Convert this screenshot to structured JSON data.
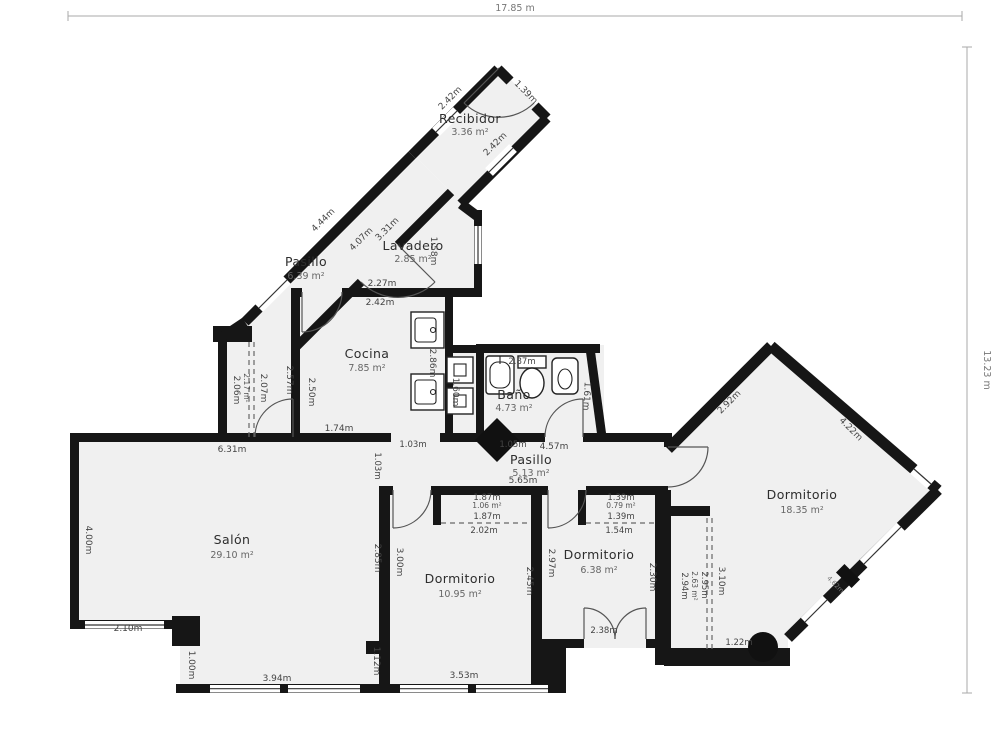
{
  "overall": {
    "width": "17.85 m",
    "height": "13.23 m"
  },
  "recibidor": {
    "name": "Recibidor",
    "area": "3.36 m²",
    "dim_nw": "2.42m",
    "dim_ne": "1.39m",
    "dim_se": "2.42m"
  },
  "pasillo_sup": {
    "name": "Pasillo",
    "area": "6.39 m²",
    "dim_outer": "4.44m",
    "dim_inner_a": "4.07m",
    "dim_inner_b": "3.31m"
  },
  "lavadero": {
    "name": "Lavadero",
    "area": "2.85 m²",
    "dim_right": "1.58m",
    "dim_bottom_inner": "2.27m",
    "dim_bottom_outer": "2.42m"
  },
  "cocina": {
    "name": "Cocina",
    "area": "7.85 m²",
    "dim_left_outer": "2.57m",
    "dim_left_inner": "2.50m",
    "dim_right": "2.86m",
    "dim_bottom": "1.74m",
    "dim_closet": "1.60m"
  },
  "vestibulo": {
    "dim_wall": "2.06m",
    "area_label": "2.17 m²",
    "dim_opening": "2.07m"
  },
  "bano": {
    "name": "Baño",
    "area": "4.73 m²",
    "dim_top": "2.87m",
    "dim_right": "1.61m",
    "dim_bottom": "1.05m"
  },
  "pasillo_inf": {
    "name": "Pasillo",
    "area": "5.13 m²",
    "dim_top": "4.57m",
    "dim_bottom": "5.65m",
    "dim_opening_h": "1.03m",
    "dim_opening_v": "1.03m"
  },
  "salon": {
    "name": "Salón",
    "area": "29.10 m²",
    "dim_top": "6.31m",
    "dim_left": "4.00m",
    "dim_bottom_left": "2.10m",
    "dim_step": "1.00m",
    "dim_bottom": "3.94m",
    "dim_right_step": "1.12m",
    "dim_right": "2.85m"
  },
  "dorm1": {
    "name": "Dormitorio",
    "area": "10.95 m²",
    "dim_left": "3.00m",
    "dim_right": "2.45m",
    "dim_bottom": "3.53m"
  },
  "closet1": {
    "area": "1.06 m²",
    "dim_a": "1.87m",
    "dim_b": "1.87m",
    "dim_c": "2.02m"
  },
  "dorm2": {
    "name": "Dormitorio",
    "area": "6.38 m²",
    "dim_left": "2.97m",
    "dim_right": "2.30m",
    "dim_door": "2.38m"
  },
  "closet2": {
    "area": "0.79 m²",
    "dim_a": "1.39m",
    "dim_b": "1.39m",
    "dim_c": "1.54m"
  },
  "galeria": {
    "area": "2.63 m²",
    "dim_a": "2.94m",
    "dim_b": "2.95m",
    "dim_c": "3.10m",
    "dim_bottom": "1.22m"
  },
  "dorm3": {
    "name": "Dormitorio",
    "area": "18.35 m²",
    "dim_nw": "2.92m",
    "dim_ne": "4.22m",
    "dim_se": "4.62m"
  },
  "fixtures": [
    "kitchen-sink",
    "kitchen-sink",
    "washer",
    "washer",
    "bath-sink",
    "toilet",
    "bidet",
    "column-diamond",
    "column-round",
    "column-square",
    "radiator"
  ]
}
